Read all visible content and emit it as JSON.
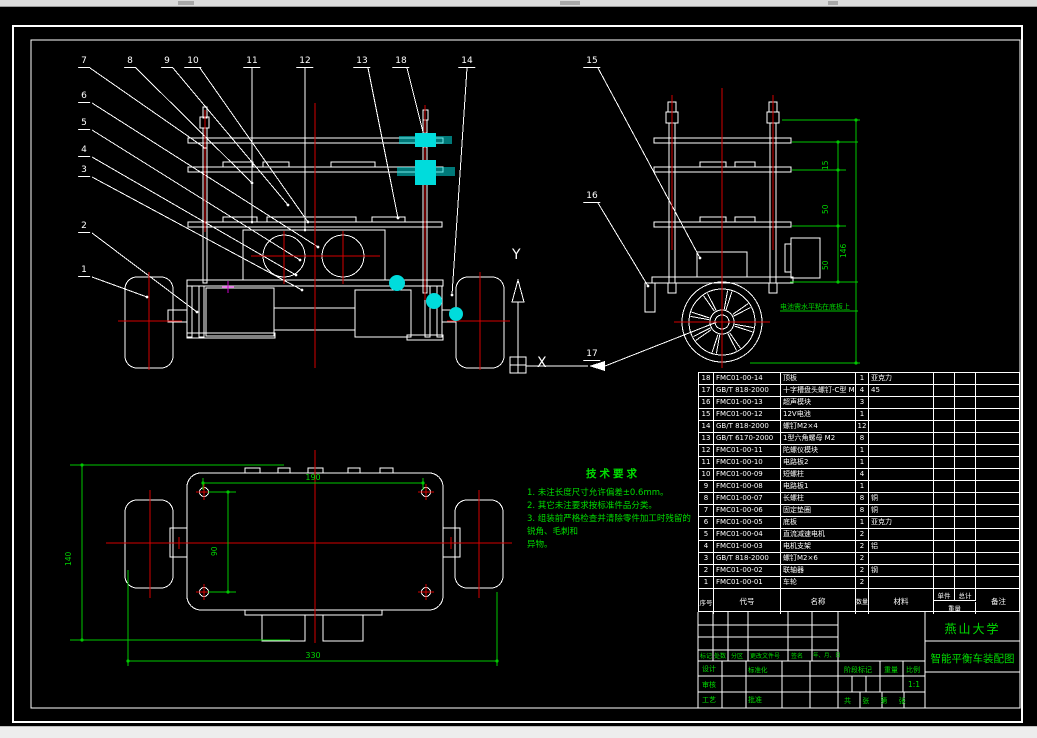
{
  "colors": {
    "background": "#000000",
    "lines": "#ffffff",
    "dimension_green": "#00d400",
    "centerline_red": "#d40000",
    "highlight_cyan": "#00dcdc"
  },
  "balloons": [
    "1",
    "2",
    "3",
    "4",
    "5",
    "6",
    "7",
    "8",
    "9",
    "10",
    "11",
    "12",
    "13",
    "14",
    "15",
    "16",
    "17",
    "18"
  ],
  "axis": {
    "x_label": "X",
    "y_label": "Y"
  },
  "dims": {
    "top_view": {
      "hole_span": "190",
      "hole_vertical": "90",
      "body_length": "140",
      "overall_width": "330"
    },
    "side_view": {
      "gap_top": "15",
      "gap_mid": "50",
      "gap_bottom": "50",
      "overall_height": "146"
    }
  },
  "side_note": "电池需水平粘在底板上",
  "tech_req": {
    "title": "技术要求",
    "lines": [
      "1. 未注长度尺寸允许偏差±0.6mm。",
      "2. 其它未注要求按标准件品分类。",
      "3. 组装前严格检查并清除零件加工时残留的锐角、毛刺和",
      "异物。"
    ]
  },
  "bom": {
    "headers": {
      "no": "序号",
      "code": "代号",
      "name": "名称",
      "qty": "数量",
      "material": "材料",
      "unit": "单件",
      "total": "总计",
      "weight": "重量",
      "remark": "备注"
    },
    "rows": [
      {
        "no": "1",
        "code": "FMC01-00-01",
        "name": "车轮",
        "qty": "2",
        "material": "",
        "unit": "",
        "total": "",
        "remark": ""
      },
      {
        "no": "2",
        "code": "FMC01-00-02",
        "name": "联轴器",
        "qty": "2",
        "material": "钢",
        "unit": "",
        "total": "",
        "remark": ""
      },
      {
        "no": "3",
        "code": "GB/T 818-2000",
        "name": "螺钉M2×6",
        "qty": "2",
        "material": "",
        "unit": "",
        "total": "",
        "remark": ""
      },
      {
        "no": "4",
        "code": "FMC01-00-03",
        "name": "电机支架",
        "qty": "2",
        "material": "铝",
        "unit": "",
        "total": "",
        "remark": ""
      },
      {
        "no": "5",
        "code": "FMC01-00-04",
        "name": "直流减速电机",
        "qty": "2",
        "material": "",
        "unit": "",
        "total": "",
        "remark": ""
      },
      {
        "no": "6",
        "code": "FMC01-00-05",
        "name": "底板",
        "qty": "1",
        "material": "亚克力",
        "unit": "",
        "total": "",
        "remark": ""
      },
      {
        "no": "7",
        "code": "FMC01-00-06",
        "name": "固定垫圈",
        "qty": "8",
        "material": "铜",
        "unit": "",
        "total": "",
        "remark": ""
      },
      {
        "no": "8",
        "code": "FMC01-00-07",
        "name": "长螺柱",
        "qty": "8",
        "material": "铜",
        "unit": "",
        "total": "",
        "remark": ""
      },
      {
        "no": "9",
        "code": "FMC01-00-08",
        "name": "电路板1",
        "qty": "1",
        "material": "",
        "unit": "",
        "total": "",
        "remark": ""
      },
      {
        "no": "10",
        "code": "FMC01-00-09",
        "name": "短螺柱",
        "qty": "4",
        "material": "",
        "unit": "",
        "total": "",
        "remark": ""
      },
      {
        "no": "11",
        "code": "FMC01-00-10",
        "name": "电路板2",
        "qty": "1",
        "material": "",
        "unit": "",
        "total": "",
        "remark": ""
      },
      {
        "no": "12",
        "code": "FMC01-00-11",
        "name": "陀螺仪模块",
        "qty": "1",
        "material": "",
        "unit": "",
        "total": "",
        "remark": ""
      },
      {
        "no": "13",
        "code": "GB/T 6170-2000",
        "name": "1型六角螺母 M2",
        "qty": "8",
        "material": "",
        "unit": "",
        "total": "",
        "remark": ""
      },
      {
        "no": "14",
        "code": "GB/T 818-2000",
        "name": "螺钉M2×4",
        "qty": "12",
        "material": "",
        "unit": "",
        "total": "",
        "remark": ""
      },
      {
        "no": "15",
        "code": "FMC01-00-12",
        "name": "12V电池",
        "qty": "1",
        "material": "",
        "unit": "",
        "total": "",
        "remark": ""
      },
      {
        "no": "16",
        "code": "FMC01-00-13",
        "name": "超声模块",
        "qty": "3",
        "material": "",
        "unit": "",
        "total": "",
        "remark": ""
      },
      {
        "no": "17",
        "code": "GB/T 818-2000",
        "name": "十字槽盘头螺钉-C型 M3×4",
        "qty": "4",
        "material": "45",
        "unit": "",
        "total": "",
        "remark": ""
      },
      {
        "no": "18",
        "code": "FMC01-00-14",
        "name": "顶板",
        "qty": "1",
        "material": "亚克力",
        "unit": "",
        "total": "",
        "remark": ""
      }
    ]
  },
  "title_block": {
    "university": "燕山大学",
    "drawing_title": "智能平衡车装配图",
    "labels": {
      "mark": "标记",
      "count": "处数",
      "zone": "分区",
      "change_doc": "更改文件号",
      "signature": "签名",
      "date": "年、月、日",
      "design": "设计",
      "standardization": "标准化",
      "review": "审核",
      "process": "工艺",
      "approve": "批准",
      "stage_mark": "阶段标记",
      "weight": "重量",
      "scale": "比例"
    },
    "scale_value": "1:1",
    "sheet_info": "共 张 第 张"
  }
}
